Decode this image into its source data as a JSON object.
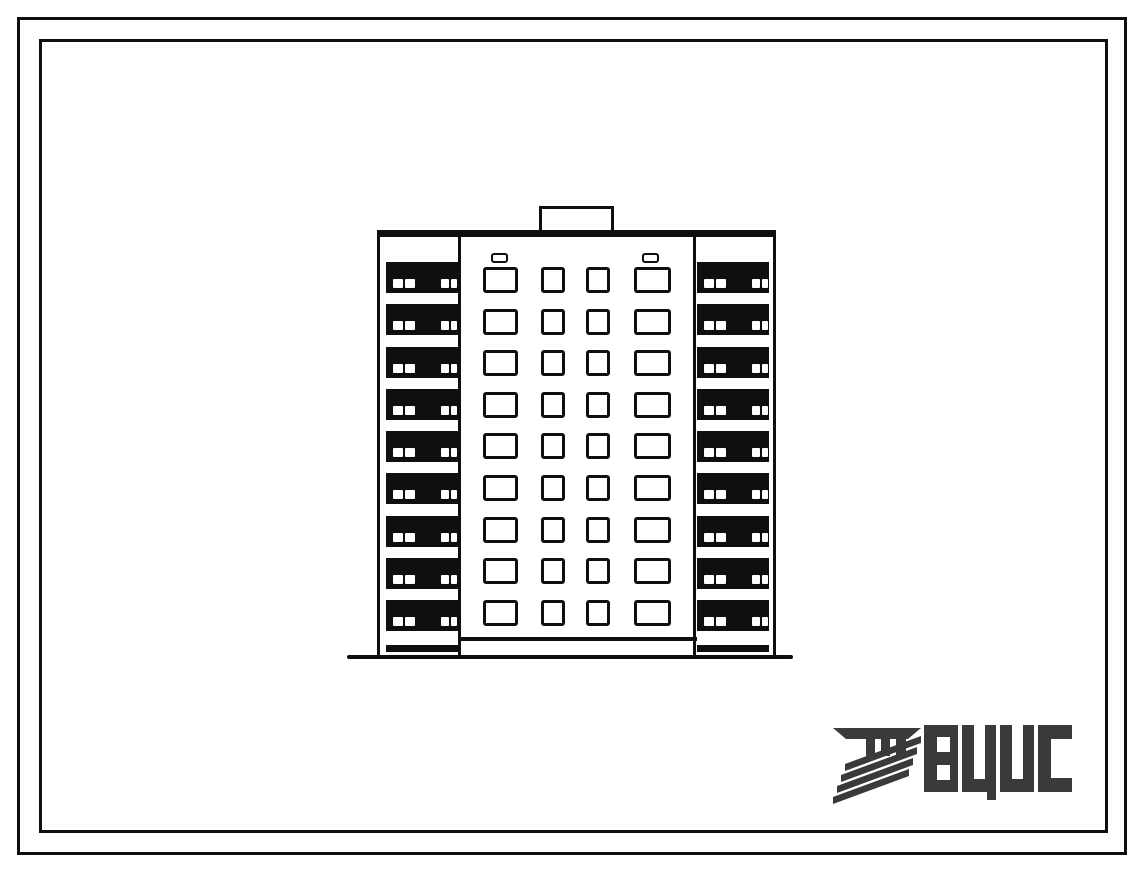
{
  "document": {
    "type": "scanned architectural typical-design sheet",
    "background_color": "#ffffff",
    "ink_color": "#0f0f0f"
  },
  "drawing": {
    "subject": "end elevation of a nine-storey large-panel apartment block",
    "floors": 9,
    "window_rows": 9,
    "window_column_sizes": [
      "large",
      "small",
      "small",
      "large"
    ],
    "roof_vents": 2,
    "balcony_sides": [
      "left",
      "right"
    ],
    "balcony_openings_per_band": 4,
    "has_roof_penthouse": true,
    "has_ground_line": true
  },
  "logo": {
    "text": "ВЦИС",
    "color": "#3a3a3d",
    "mark": "striped-column-emblem"
  }
}
